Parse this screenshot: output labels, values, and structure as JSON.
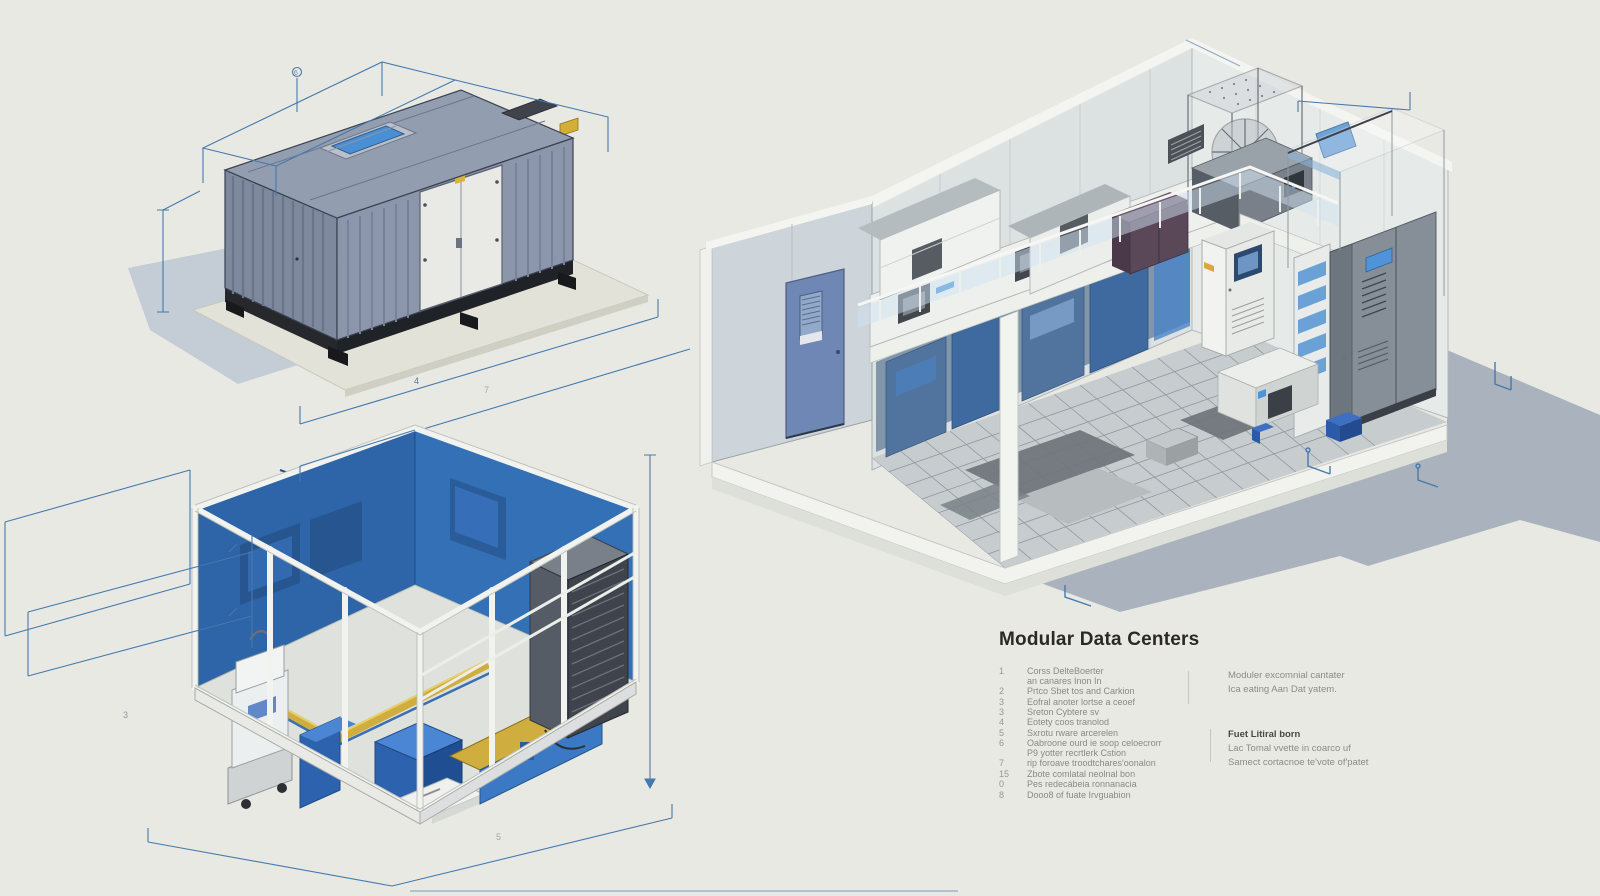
{
  "title": "Modular Data Centers",
  "legend": {
    "items": [
      {
        "num": "1",
        "text": "Corss DelteBoerter\nan canares Inon In"
      },
      {
        "num": "2",
        "text": "Prtco Sbet tos and Carkion"
      },
      {
        "num": "3",
        "text": "Eofral anoter lortse a ceoef"
      },
      {
        "num": "3",
        "text": "Sreton Cybtere sv"
      },
      {
        "num": "4",
        "text": "Eotety coos tranolod"
      },
      {
        "num": "5",
        "text": "Sxrotu rware arcerelen"
      },
      {
        "num": "6",
        "text": "Oabroone ourd ie soop celoecrorr\nP9 yotter recrtlerk Cstion"
      },
      {
        "num": "7",
        "text": "rip foroave troodtchares'oonalon"
      },
      {
        "num": "15",
        "text": "Zbote comlatal neolnal bon"
      },
      {
        "num": "0",
        "text": "Pes redecábeia ronnanacia"
      },
      {
        "num": "8",
        "text": "Dooo8 of fuate Irvguabion"
      }
    ],
    "right_column": {
      "para1": "Moduler excomnial cantater\nIca eating Aan Dat yatem.",
      "heading": "Fuet Litiral born",
      "para2": "Lac Tomal vvette in coarco uf\nSamect cortacnoe te'vote of'patet"
    }
  },
  "dimension_labels": {
    "a": "6",
    "b": "4",
    "c": "7",
    "d": "3",
    "e": "5",
    "f": "4"
  },
  "colors": {
    "background": "#e9e9e4",
    "dimension_line": "#4679ad",
    "container_body": "#8c96aa",
    "container_roof": "#939db0",
    "roof_hatch_blue": "#4a8fd4",
    "label_yellow": "#d4af37",
    "interior_blue": "#2f66ab",
    "cyan_duct": "#7fc4e4",
    "door_blue": "#6f87b4",
    "cabinet_purple": "#5a4758",
    "ground_shadow": "#a6b0bb",
    "rack_dark": "#3e434c",
    "cable_tray_yellow": "#cfae3f"
  }
}
